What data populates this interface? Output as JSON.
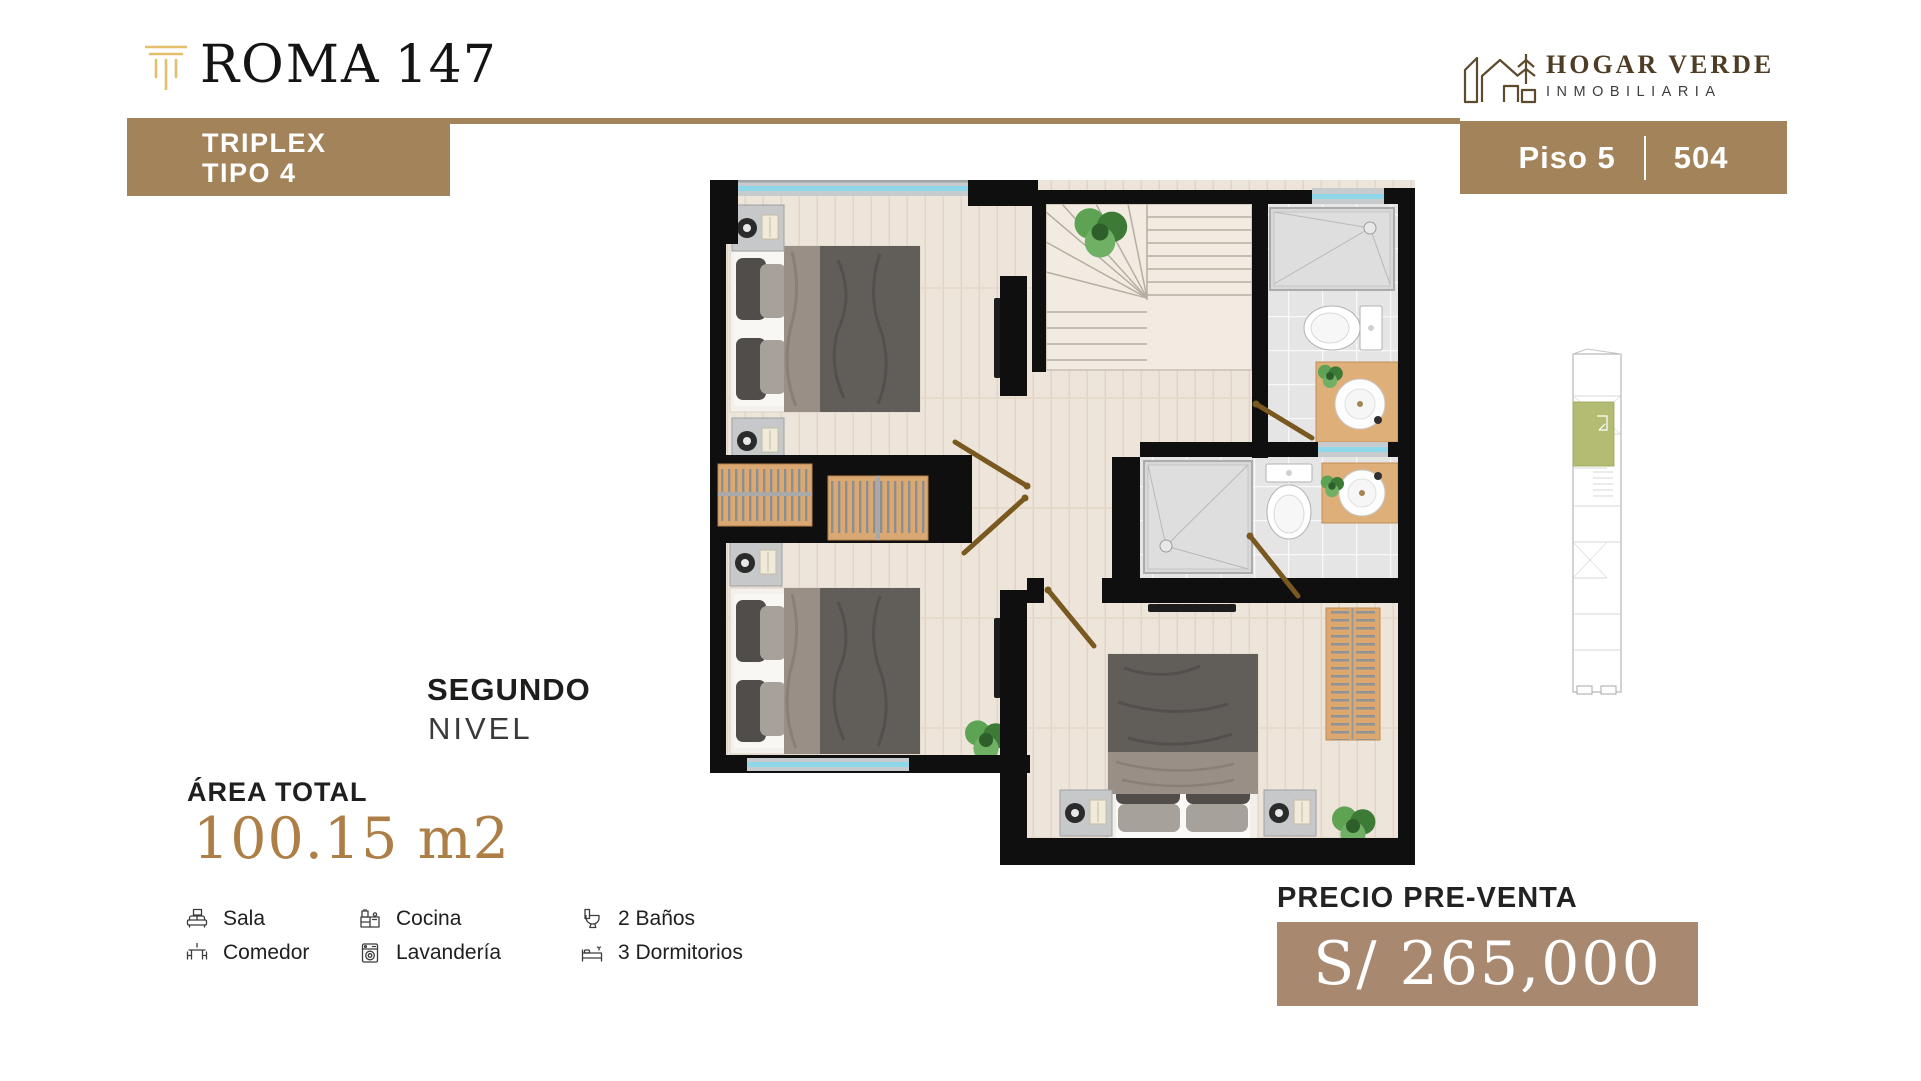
{
  "brand": {
    "name": "ROMA",
    "number": "147"
  },
  "agency": {
    "name": "HOGAR VERDE",
    "tagline": "INMOBILIARIA"
  },
  "badges": {
    "type_line1": "TRIPLEX",
    "type_line2": "TIPO 4",
    "floor": "Piso 5",
    "unit": "504"
  },
  "level": {
    "title": "SEGUNDO",
    "subtitle": "NIVEL"
  },
  "area": {
    "label": "ÁREA TOTAL",
    "value": "100.15 m2"
  },
  "features": {
    "columns": [
      {
        "items": [
          {
            "icon": "sofa-icon",
            "label": "Sala"
          },
          {
            "icon": "dining-table-icon",
            "label": "Comedor"
          }
        ]
      },
      {
        "items": [
          {
            "icon": "kitchen-icon",
            "label": "Cocina"
          },
          {
            "icon": "washing-machine-icon",
            "label": "Lavandería"
          }
        ]
      },
      {
        "items": [
          {
            "icon": "toilet-icon",
            "label": "2 Baños"
          },
          {
            "icon": "bed-icon",
            "label": "3 Dormitorios"
          }
        ]
      }
    ]
  },
  "price": {
    "label": "PRECIO PRE-VENTA",
    "value": "S/ 265,000"
  },
  "colors": {
    "brand_brown": "#A3835A",
    "price_brown": "#A98870",
    "logo_gold": "#E3BE6C",
    "area_gold": "#AD7F47",
    "agency_brown": "#5E4B2E",
    "minimap_unit_green": "#B4BC73",
    "wall_black": "#0F0F0F",
    "window_cyan": "#8FD8EA"
  }
}
